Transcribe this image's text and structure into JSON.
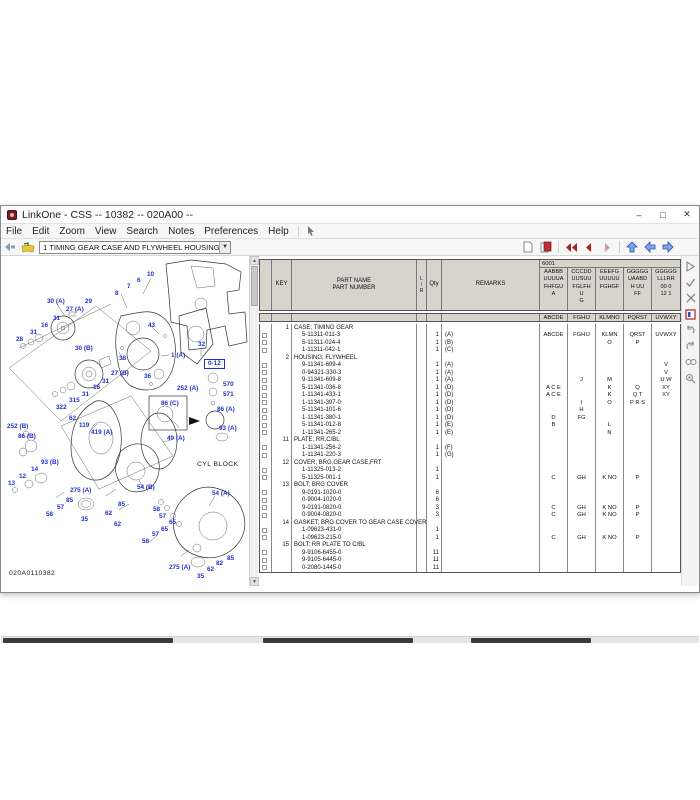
{
  "window": {
    "title": "LinkOne - CSS -- 10382 -- 020A00 --",
    "controls": {
      "minimize": "–",
      "maximize": "□",
      "close": "✕"
    }
  },
  "menu": {
    "items": [
      "File",
      "Edit",
      "Zoom",
      "View",
      "Search",
      "Notes",
      "Preferences",
      "Help"
    ]
  },
  "toolbar": {
    "view_selector": "1 TIMING GEAR CASE AND FLYWHEEL HOUSING",
    "left_icons": [
      "back-icon",
      "open-book-icon"
    ],
    "right_icons": [
      "page-icon",
      "red-book-icon",
      "first-page-icon",
      "prev-page-icon",
      "next-page-icon",
      "nav-up-icon",
      "nav-left-icon",
      "nav-right-icon"
    ],
    "accent_red": "#a82424",
    "accent_blue": "#3a62d8"
  },
  "right_toolbar": {
    "icons": [
      "run-icon",
      "check-icon",
      "cancel-icon",
      "info-icon",
      "undo-icon",
      "redo-icon",
      "find-icon",
      "zoom-icon"
    ]
  },
  "watermark": {
    "text": "MECHANIC DIESEL"
  },
  "diagram": {
    "drawing_number": "020A0110382",
    "label_color": "#2230c8",
    "labels": [
      {
        "t": "10",
        "x": 146,
        "y": 16
      },
      {
        "t": "6",
        "x": 136,
        "y": 22
      },
      {
        "t": "7",
        "x": 126,
        "y": 28
      },
      {
        "t": "8",
        "x": 114,
        "y": 35
      },
      {
        "t": "30 (A)",
        "x": 46,
        "y": 43
      },
      {
        "t": "29",
        "x": 84,
        "y": 43
      },
      {
        "t": "27 (A)",
        "x": 65,
        "y": 51
      },
      {
        "t": "31",
        "x": 52,
        "y": 60
      },
      {
        "t": "16",
        "x": 40,
        "y": 67
      },
      {
        "t": "31",
        "x": 29,
        "y": 74
      },
      {
        "t": "28",
        "x": 15,
        "y": 81
      },
      {
        "t": "43",
        "x": 147,
        "y": 67
      },
      {
        "t": "32",
        "x": 197,
        "y": 86
      },
      {
        "t": "30 (B)",
        "x": 74,
        "y": 90
      },
      {
        "t": "38",
        "x": 118,
        "y": 100
      },
      {
        "t": "1 (A)",
        "x": 170,
        "y": 97
      },
      {
        "t": "0-12",
        "x": 203,
        "y": 103,
        "k": "box"
      },
      {
        "t": "36",
        "x": 143,
        "y": 118
      },
      {
        "t": "27 (B)",
        "x": 110,
        "y": 115
      },
      {
        "t": "31",
        "x": 101,
        "y": 123
      },
      {
        "t": "16",
        "x": 92,
        "y": 129
      },
      {
        "t": "31",
        "x": 81,
        "y": 136
      },
      {
        "t": "315",
        "x": 68,
        "y": 142
      },
      {
        "t": "322",
        "x": 55,
        "y": 149
      },
      {
        "t": "252 (A)",
        "x": 176,
        "y": 130
      },
      {
        "t": "570",
        "x": 222,
        "y": 126
      },
      {
        "t": "571",
        "x": 222,
        "y": 136
      },
      {
        "t": "86 (C)",
        "x": 160,
        "y": 145
      },
      {
        "t": "86 (A)",
        "x": 216,
        "y": 151
      },
      {
        "t": "62",
        "x": 68,
        "y": 160
      },
      {
        "t": "119",
        "x": 78,
        "y": 167
      },
      {
        "t": "252 (B)",
        "x": 6,
        "y": 168
      },
      {
        "t": "419 (A)",
        "x": 90,
        "y": 174
      },
      {
        "t": "86 (B)",
        "x": 17,
        "y": 178
      },
      {
        "t": "93 (A)",
        "x": 218,
        "y": 170
      },
      {
        "t": "49 (A)",
        "x": 166,
        "y": 180
      },
      {
        "t": "93 (B)",
        "x": 40,
        "y": 204
      },
      {
        "t": "CYL BLOCK",
        "x": 196,
        "y": 206,
        "k": "blk"
      },
      {
        "t": "14",
        "x": 30,
        "y": 211
      },
      {
        "t": "12",
        "x": 18,
        "y": 218
      },
      {
        "t": "13",
        "x": 7,
        "y": 225
      },
      {
        "t": "275 (A)",
        "x": 69,
        "y": 232
      },
      {
        "t": "54 (B)",
        "x": 136,
        "y": 229
      },
      {
        "t": "54 (A)",
        "x": 211,
        "y": 235
      },
      {
        "t": "85",
        "x": 65,
        "y": 242
      },
      {
        "t": "57",
        "x": 56,
        "y": 249
      },
      {
        "t": "85",
        "x": 117,
        "y": 246
      },
      {
        "t": "58",
        "x": 45,
        "y": 256
      },
      {
        "t": "58",
        "x": 152,
        "y": 251
      },
      {
        "t": "57",
        "x": 158,
        "y": 258
      },
      {
        "t": "35",
        "x": 80,
        "y": 261
      },
      {
        "t": "62",
        "x": 104,
        "y": 255
      },
      {
        "t": "65",
        "x": 168,
        "y": 264
      },
      {
        "t": "65",
        "x": 160,
        "y": 271
      },
      {
        "t": "62",
        "x": 113,
        "y": 266
      },
      {
        "t": "57",
        "x": 151,
        "y": 276
      },
      {
        "t": "58",
        "x": 141,
        "y": 283
      },
      {
        "t": "85",
        "x": 226,
        "y": 300
      },
      {
        "t": "82",
        "x": 215,
        "y": 305
      },
      {
        "t": "62",
        "x": 206,
        "y": 311
      },
      {
        "t": "275 (A)",
        "x": 168,
        "y": 309
      },
      {
        "t": "35",
        "x": 196,
        "y": 318
      },
      {
        "t": "020A0110382",
        "x": 8,
        "y": 315,
        "k": "blk"
      }
    ]
  },
  "table": {
    "headers": {
      "key": "KEY",
      "part": "PART NAME\nPART NUMBER",
      "lr": "L\n/\nR",
      "qty": "Qty",
      "remarks": "REMARKS",
      "serial_label": "6001"
    },
    "serial_columns": [
      {
        "lines": "AABBB\nUUUUA\nFHFGU\nA",
        "code": "ABCDE"
      },
      {
        "lines": "CCCDD\nUUSUU\nFGLFH\nU\nG",
        "code": "FGHIJ"
      },
      {
        "lines": "EEEFG\nUUUUU\nFGHGF",
        "code": "KLMNO"
      },
      {
        "lines": "GGGGG\nUAABD\nH UU\nFF",
        "code": "PQRST"
      },
      {
        "lines": "GGGGG\nLLLRR\n00 0\n12 1",
        "code": "UVWXY"
      }
    ],
    "rows": [
      {
        "g": true,
        "key": "1",
        "name": "CASE; TIMING GEAR"
      },
      {
        "num": "5-11311-011-3",
        "qty": "1",
        "rem": "(A)",
        "c": [
          "ABCDE",
          "FGHIJ",
          "KLMN",
          "QRST",
          "UVWXY"
        ]
      },
      {
        "num": "5-11311-024-4",
        "qty": "1",
        "rem": "(B)",
        "c": [
          "",
          "",
          "O",
          "P",
          ""
        ]
      },
      {
        "num": "1-11311-042-1",
        "qty": "1",
        "rem": "(C)",
        "c": [
          "",
          "",
          "",
          "",
          ""
        ]
      },
      {
        "g": true,
        "key": "2",
        "name": "HOUSING; FLYWHEEL"
      },
      {
        "num": "9-11341-609-4",
        "qty": "1",
        "rem": "(A)",
        "c": [
          "",
          "",
          "",
          "",
          "V"
        ]
      },
      {
        "num": "0-94321-330-3",
        "qty": "1",
        "rem": "(A)",
        "c": [
          "",
          "",
          "",
          "",
          "V"
        ]
      },
      {
        "num": "9-11341-609-8",
        "qty": "1",
        "rem": "(A)",
        "c": [
          "",
          "J",
          "M",
          "",
          "U W"
        ]
      },
      {
        "num": "5-11341-036-8",
        "qty": "1",
        "rem": "(D)",
        "c": [
          "A C E",
          "",
          "K",
          "Q",
          "XY"
        ]
      },
      {
        "num": "1-11341-433-1",
        "qty": "1",
        "rem": "(D)",
        "c": [
          "A C E",
          "",
          "K",
          "Q T",
          "XY"
        ]
      },
      {
        "num": "1-11341-397-0",
        "qty": "1",
        "rem": "(D)",
        "c": [
          "",
          "I",
          "O",
          "P R S",
          ""
        ]
      },
      {
        "num": "5-11341-101-6",
        "qty": "1",
        "rem": "(D)",
        "c": [
          "",
          "H",
          "",
          "",
          ""
        ]
      },
      {
        "num": "1-11341-380-1",
        "qty": "1",
        "rem": "(D)",
        "c": [
          "D",
          "FG",
          "",
          "",
          ""
        ]
      },
      {
        "num": "5-11341-012-8",
        "qty": "1",
        "rem": "(E)",
        "c": [
          "B",
          "",
          "L",
          "",
          ""
        ]
      },
      {
        "num": "1-11341-265-2",
        "qty": "1",
        "rem": "(E)",
        "c": [
          "",
          "",
          "N",
          "",
          ""
        ]
      },
      {
        "g": true,
        "key": "11",
        "name": "PLATE; RR,C/BL"
      },
      {
        "num": "1-11341-256-2",
        "qty": "1",
        "rem": "(F)",
        "c": [
          "",
          "",
          "",
          "",
          ""
        ]
      },
      {
        "num": "1-11341-220-3",
        "qty": "1",
        "rem": "(G)",
        "c": [
          "",
          "",
          "",
          "",
          ""
        ]
      },
      {
        "g": true,
        "key": "12",
        "name": "COVER; BRG,GEAR CASE,FRT"
      },
      {
        "num": "1-11325-013-2",
        "qty": "1",
        "rem": "",
        "c": [
          "",
          "",
          "",
          "",
          ""
        ]
      },
      {
        "num": "5-11325-001-1",
        "qty": "1",
        "rem": "",
        "c": [
          "C",
          "GH",
          "K NO",
          "P",
          ""
        ]
      },
      {
        "g": true,
        "key": "13",
        "name": "BOLT; BRG COVER"
      },
      {
        "num": "9-0191-1020-0",
        "qty": "6",
        "rem": "",
        "c": [
          "",
          "",
          "",
          "",
          ""
        ]
      },
      {
        "num": "0-9004-1020-0",
        "qty": "6",
        "rem": "",
        "c": [
          "",
          "",
          "",
          "",
          ""
        ]
      },
      {
        "num": "9-0191-0820-0",
        "qty": "3",
        "rem": "",
        "c": [
          "C",
          "GH",
          "K NO",
          "P",
          ""
        ]
      },
      {
        "num": "0-9004-0820-0",
        "qty": "3",
        "rem": "",
        "c": [
          "C",
          "GH",
          "K NO",
          "P",
          ""
        ]
      },
      {
        "g": true,
        "key": "14",
        "name": "GASKET; BRG COVER TO GEAR CASE COVER"
      },
      {
        "num": "1-09623-431-0",
        "qty": "1",
        "rem": "",
        "c": [
          "",
          "",
          "",
          "",
          ""
        ]
      },
      {
        "num": "1-09623-215-0",
        "qty": "1",
        "rem": "",
        "c": [
          "C",
          "GH",
          "K NO",
          "P",
          ""
        ]
      },
      {
        "g": true,
        "key": "15",
        "name": "BOLT; RR PLATE TO C/BL"
      },
      {
        "num": "9-9106-6455-0",
        "qty": "11",
        "rem": "",
        "c": [
          "",
          "",
          "",
          "",
          ""
        ]
      },
      {
        "num": "9-9105-6445-0",
        "qty": "11",
        "rem": "",
        "c": [
          "",
          "",
          "",
          "",
          ""
        ]
      },
      {
        "num": "0-2080-1445-0",
        "qty": "11",
        "rem": "",
        "c": [
          "",
          "",
          "",
          "",
          ""
        ]
      }
    ]
  }
}
